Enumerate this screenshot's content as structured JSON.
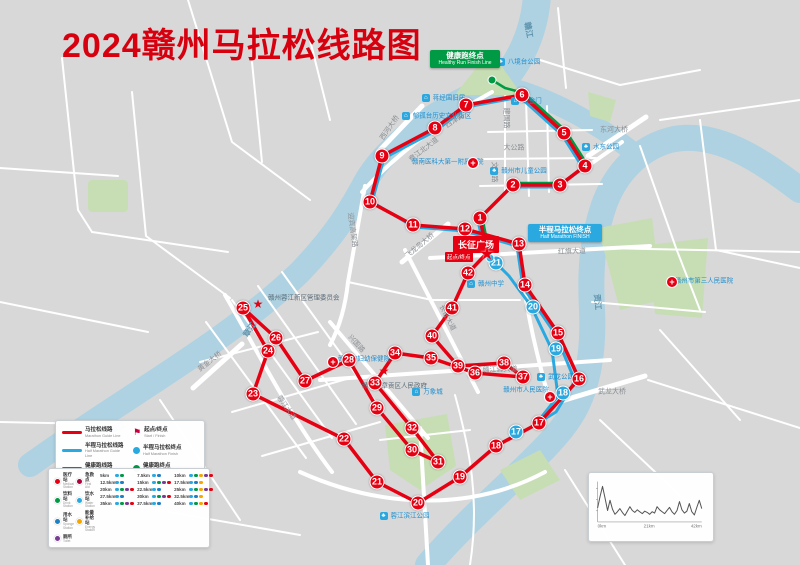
{
  "title": "2024赣州马拉松线路图",
  "square_label": "长征广场",
  "start_tag": "起点/终点",
  "half_finish": {
    "zh": "半程马拉松终点",
    "en": "Half Marathon FINISH"
  },
  "healthy_finish": {
    "zh": "健康跑终点",
    "en": "Healthy Run Finish Line"
  },
  "colors": {
    "route_red": "#e60012",
    "route_blue": "#29a9e0",
    "route_green": "#009944",
    "river": "#aed2e2",
    "park": "#c7deb4",
    "background": "#d8d8d8",
    "title_red": "#d7000f"
  },
  "route_legend": {
    "lines": [
      {
        "color": "#e60012",
        "zh": "马拉松线路",
        "en": "Marathon Guide Line"
      },
      {
        "color": "#29a9e0",
        "zh": "半程马拉松线路",
        "en": "Half Marathon Guide Line"
      },
      {
        "color": "#009944",
        "zh": "健康跑线路",
        "en": "Health Run Guide Line"
      }
    ],
    "points": [
      {
        "color": "#c8003c",
        "icon": "flag",
        "zh": "起点/终点",
        "en": "Start / Finish"
      },
      {
        "color": "#29a9e0",
        "icon": "dot",
        "zh": "半程马拉松终点",
        "en": "Half Marathon Finish"
      },
      {
        "color": "#009944",
        "icon": "dot",
        "zh": "健康跑终点",
        "en": "Healthy Run Finish Line"
      }
    ]
  },
  "service_legend": {
    "items": [
      {
        "code": "m",
        "color": "#e60012",
        "zh": "医疗站",
        "en": "Medical Station"
      },
      {
        "code": "a",
        "color": "#b0003a",
        "zh": "急救点",
        "en": "First Aid"
      },
      {
        "code": "d",
        "color": "#009944",
        "zh": "饮料站",
        "en": "Drink Station"
      },
      {
        "code": "w",
        "color": "#29a9e0",
        "zh": "饮水站",
        "en": "Water Station"
      },
      {
        "code": "s",
        "color": "#1d7fc4",
        "zh": "用水站",
        "en": "Sponge Station"
      },
      {
        "code": "e",
        "color": "#f7a600",
        "zh": "能量补给站",
        "en": "Energy Station"
      },
      {
        "code": "t",
        "color": "#7a3b96",
        "zh": "厕所",
        "en": "Toilet"
      }
    ],
    "km_points": [
      {
        "km": "5km",
        "dots": [
          "w",
          "d"
        ]
      },
      {
        "km": "7.5km",
        "dots": [
          "w",
          "s"
        ]
      },
      {
        "km": "10km",
        "dots": [
          "w",
          "d",
          "e",
          "t",
          "m"
        ]
      },
      {
        "km": "12.5km",
        "dots": [
          "w",
          "s"
        ]
      },
      {
        "km": "15km",
        "dots": [
          "w",
          "d",
          "t",
          "m"
        ]
      },
      {
        "km": "17.5km",
        "dots": [
          "w",
          "s",
          "e"
        ]
      },
      {
        "km": "20km",
        "dots": [
          "w",
          "d",
          "t",
          "m"
        ]
      },
      {
        "km": "22.5km",
        "dots": [
          "w",
          "s"
        ]
      },
      {
        "km": "25km",
        "dots": [
          "w",
          "d",
          "e",
          "t",
          "m"
        ]
      },
      {
        "km": "27.5km",
        "dots": [
          "w",
          "s"
        ]
      },
      {
        "km": "30km",
        "dots": [
          "w",
          "d",
          "t",
          "m"
        ]
      },
      {
        "km": "32.5km",
        "dots": [
          "w",
          "s",
          "e"
        ]
      },
      {
        "km": "35km",
        "dots": [
          "w",
          "d",
          "t",
          "m"
        ]
      },
      {
        "km": "37.5km",
        "dots": [
          "w",
          "s"
        ]
      },
      {
        "km": "40km",
        "dots": [
          "w",
          "d",
          "e",
          "m"
        ]
      }
    ]
  },
  "checkpoints": {
    "marathon": [
      {
        "n": 1,
        "x": 480,
        "y": 218
      },
      {
        "n": 2,
        "x": 513,
        "y": 185
      },
      {
        "n": 3,
        "x": 560,
        "y": 185
      },
      {
        "n": 4,
        "x": 585,
        "y": 166
      },
      {
        "n": 5,
        "x": 564,
        "y": 133
      },
      {
        "n": 6,
        "x": 522,
        "y": 95
      },
      {
        "n": 7,
        "x": 466,
        "y": 105
      },
      {
        "n": 8,
        "x": 435,
        "y": 128
      },
      {
        "n": 9,
        "x": 382,
        "y": 156
      },
      {
        "n": 10,
        "x": 370,
        "y": 202
      },
      {
        "n": 11,
        "x": 413,
        "y": 225
      },
      {
        "n": 12,
        "x": 465,
        "y": 229
      },
      {
        "n": 13,
        "x": 519,
        "y": 244
      },
      {
        "n": 14,
        "x": 525,
        "y": 285
      },
      {
        "n": 15,
        "x": 558,
        "y": 333
      },
      {
        "n": 16,
        "x": 579,
        "y": 379
      },
      {
        "n": 17,
        "x": 539,
        "y": 423
      },
      {
        "n": 18,
        "x": 496,
        "y": 446
      },
      {
        "n": 19,
        "x": 460,
        "y": 477
      },
      {
        "n": 20,
        "x": 418,
        "y": 503
      },
      {
        "n": 21,
        "x": 377,
        "y": 482
      },
      {
        "n": 22,
        "x": 344,
        "y": 439
      },
      {
        "n": 23,
        "x": 253,
        "y": 394
      },
      {
        "n": 24,
        "x": 268,
        "y": 351
      },
      {
        "n": 25,
        "x": 243,
        "y": 308
      },
      {
        "n": 26,
        "x": 276,
        "y": 338
      },
      {
        "n": 27,
        "x": 305,
        "y": 381
      },
      {
        "n": 28,
        "x": 349,
        "y": 360
      },
      {
        "n": 29,
        "x": 377,
        "y": 408
      },
      {
        "n": 30,
        "x": 412,
        "y": 450
      },
      {
        "n": 31,
        "x": 438,
        "y": 462
      },
      {
        "n": 32,
        "x": 412,
        "y": 428
      },
      {
        "n": 33,
        "x": 375,
        "y": 383
      },
      {
        "n": 34,
        "x": 395,
        "y": 353
      },
      {
        "n": 35,
        "x": 431,
        "y": 358
      },
      {
        "n": 36,
        "x": 475,
        "y": 373
      },
      {
        "n": 37,
        "x": 523,
        "y": 377
      },
      {
        "n": 38,
        "x": 504,
        "y": 363
      },
      {
        "n": 39,
        "x": 458,
        "y": 366
      },
      {
        "n": 40,
        "x": 432,
        "y": 336
      },
      {
        "n": 41,
        "x": 452,
        "y": 308
      },
      {
        "n": 42,
        "x": 468,
        "y": 273
      }
    ],
    "half": [
      {
        "n": 17,
        "x": 516,
        "y": 432
      },
      {
        "n": 18,
        "x": 563,
        "y": 393
      },
      {
        "n": 19,
        "x": 556,
        "y": 349
      },
      {
        "n": 20,
        "x": 533,
        "y": 307
      },
      {
        "n": 21,
        "x": 496,
        "y": 263
      }
    ]
  },
  "streets": [
    {
      "t": "章江北大道",
      "x": 424,
      "y": 150,
      "r": -38
    },
    {
      "t": "西津路",
      "x": 455,
      "y": 121,
      "r": -33
    },
    {
      "t": "西河大桥",
      "x": 390,
      "y": 128,
      "r": -55
    },
    {
      "t": "东河大桥",
      "x": 614,
      "y": 130,
      "r": 0
    },
    {
      "t": "建国路",
      "x": 506,
      "y": 118,
      "r": 90
    },
    {
      "t": "文清路",
      "x": 494,
      "y": 172,
      "r": 90
    },
    {
      "t": "大公路",
      "x": 514,
      "y": 148,
      "r": 0
    },
    {
      "t": "红旗大道",
      "x": 572,
      "y": 252,
      "r": -2
    },
    {
      "t": "赣江源大道",
      "x": 500,
      "y": 370,
      "r": -2
    },
    {
      "t": "长征大道",
      "x": 447,
      "y": 318,
      "r": 63
    },
    {
      "t": "兴国路",
      "x": 356,
      "y": 344,
      "r": 48
    },
    {
      "t": "武龙大桥",
      "x": 612,
      "y": 392,
      "r": 0
    },
    {
      "t": "黄金大桥",
      "x": 210,
      "y": 362,
      "r": -38
    },
    {
      "t": "迎宾高架路",
      "x": 352,
      "y": 230,
      "r": 82
    },
    {
      "t": "蓉江大道",
      "x": 286,
      "y": 408,
      "r": 55
    },
    {
      "t": "飞龙岛大桥",
      "x": 420,
      "y": 246,
      "r": -40
    },
    {
      "t": "章江",
      "x": 250,
      "y": 330,
      "r": -55,
      "c": "water"
    },
    {
      "t": "章江",
      "x": 118,
      "y": 428,
      "r": -28,
      "c": "water"
    },
    {
      "t": "贡江",
      "x": 597,
      "y": 302,
      "r": 85,
      "c": "water"
    },
    {
      "t": "赣江",
      "x": 528,
      "y": 30,
      "r": 80,
      "c": "water"
    }
  ],
  "landmarks": [
    {
      "t": "八境台公园",
      "x": 524,
      "y": 62,
      "k": "park"
    },
    {
      "t": "涌金门",
      "x": 532,
      "y": 101,
      "k": "site"
    },
    {
      "t": "蒋经国旧居",
      "x": 449,
      "y": 98,
      "k": "site"
    },
    {
      "t": "郁孤台历史文化街区",
      "x": 442,
      "y": 116,
      "k": "site"
    },
    {
      "t": "赣州市儿童公园",
      "x": 524,
      "y": 171,
      "k": "park"
    },
    {
      "t": "水东公园",
      "x": 606,
      "y": 147,
      "k": "park"
    },
    {
      "t": "赣南医科大第一附属医院",
      "x": 444,
      "y": 162,
      "k": "hospital",
      "ix": 473,
      "iy": 163
    },
    {
      "t": "赣州市人民医院",
      "x": 526,
      "y": 390,
      "k": "hospital",
      "ix": 550,
      "iy": 397
    },
    {
      "t": "赣州市妇幼保健院",
      "x": 364,
      "y": 359,
      "k": "hospital",
      "ix": 333,
      "iy": 362
    },
    {
      "t": "赣州市第三人民医院",
      "x": 704,
      "y": 281,
      "k": "hospital",
      "ix": 672,
      "iy": 282
    },
    {
      "t": "赣州市章贡区人民政府",
      "x": 394,
      "y": 386,
      "k": "star",
      "ix": 384,
      "iy": 371
    },
    {
      "t": "赣州蓉江新区管理委员会",
      "x": 300,
      "y": 298,
      "k": "star",
      "ix": 258,
      "iy": 304
    },
    {
      "t": "万象城",
      "x": 433,
      "y": 392,
      "k": "site"
    },
    {
      "t": "武龙公园",
      "x": 561,
      "y": 377,
      "k": "park"
    },
    {
      "t": "蓉江滨江公园",
      "x": 410,
      "y": 516,
      "k": "park"
    },
    {
      "t": "赣州中学",
      "x": 491,
      "y": 284,
      "k": "site"
    }
  ],
  "chart_data": {
    "type": "line",
    "title": "赛道高程示意",
    "x_ticks": [
      "0km",
      "21km",
      "42km"
    ],
    "x_km": [
      0,
      1,
      2,
      3,
      4,
      5,
      6,
      7,
      8,
      9,
      10,
      11,
      12,
      13,
      14,
      15,
      16,
      17,
      18,
      19,
      20,
      21,
      22,
      23,
      24,
      25,
      26,
      27,
      28,
      29,
      30,
      31,
      32,
      33,
      34,
      35,
      36,
      37,
      38,
      39,
      40,
      41,
      42
    ],
    "values": [
      102,
      120,
      136,
      118,
      98,
      114,
      100,
      92,
      96,
      101,
      95,
      90,
      97,
      104,
      98,
      95,
      99,
      96,
      93,
      97,
      95,
      92,
      96,
      94,
      104,
      99,
      96,
      93,
      98,
      103,
      96,
      92,
      98,
      112,
      99,
      94,
      97,
      109,
      96,
      91,
      103,
      114,
      101
    ],
    "ylim": [
      80,
      140
    ],
    "ylabel": "海拔(m)",
    "grid": false,
    "legend_position": "none"
  }
}
